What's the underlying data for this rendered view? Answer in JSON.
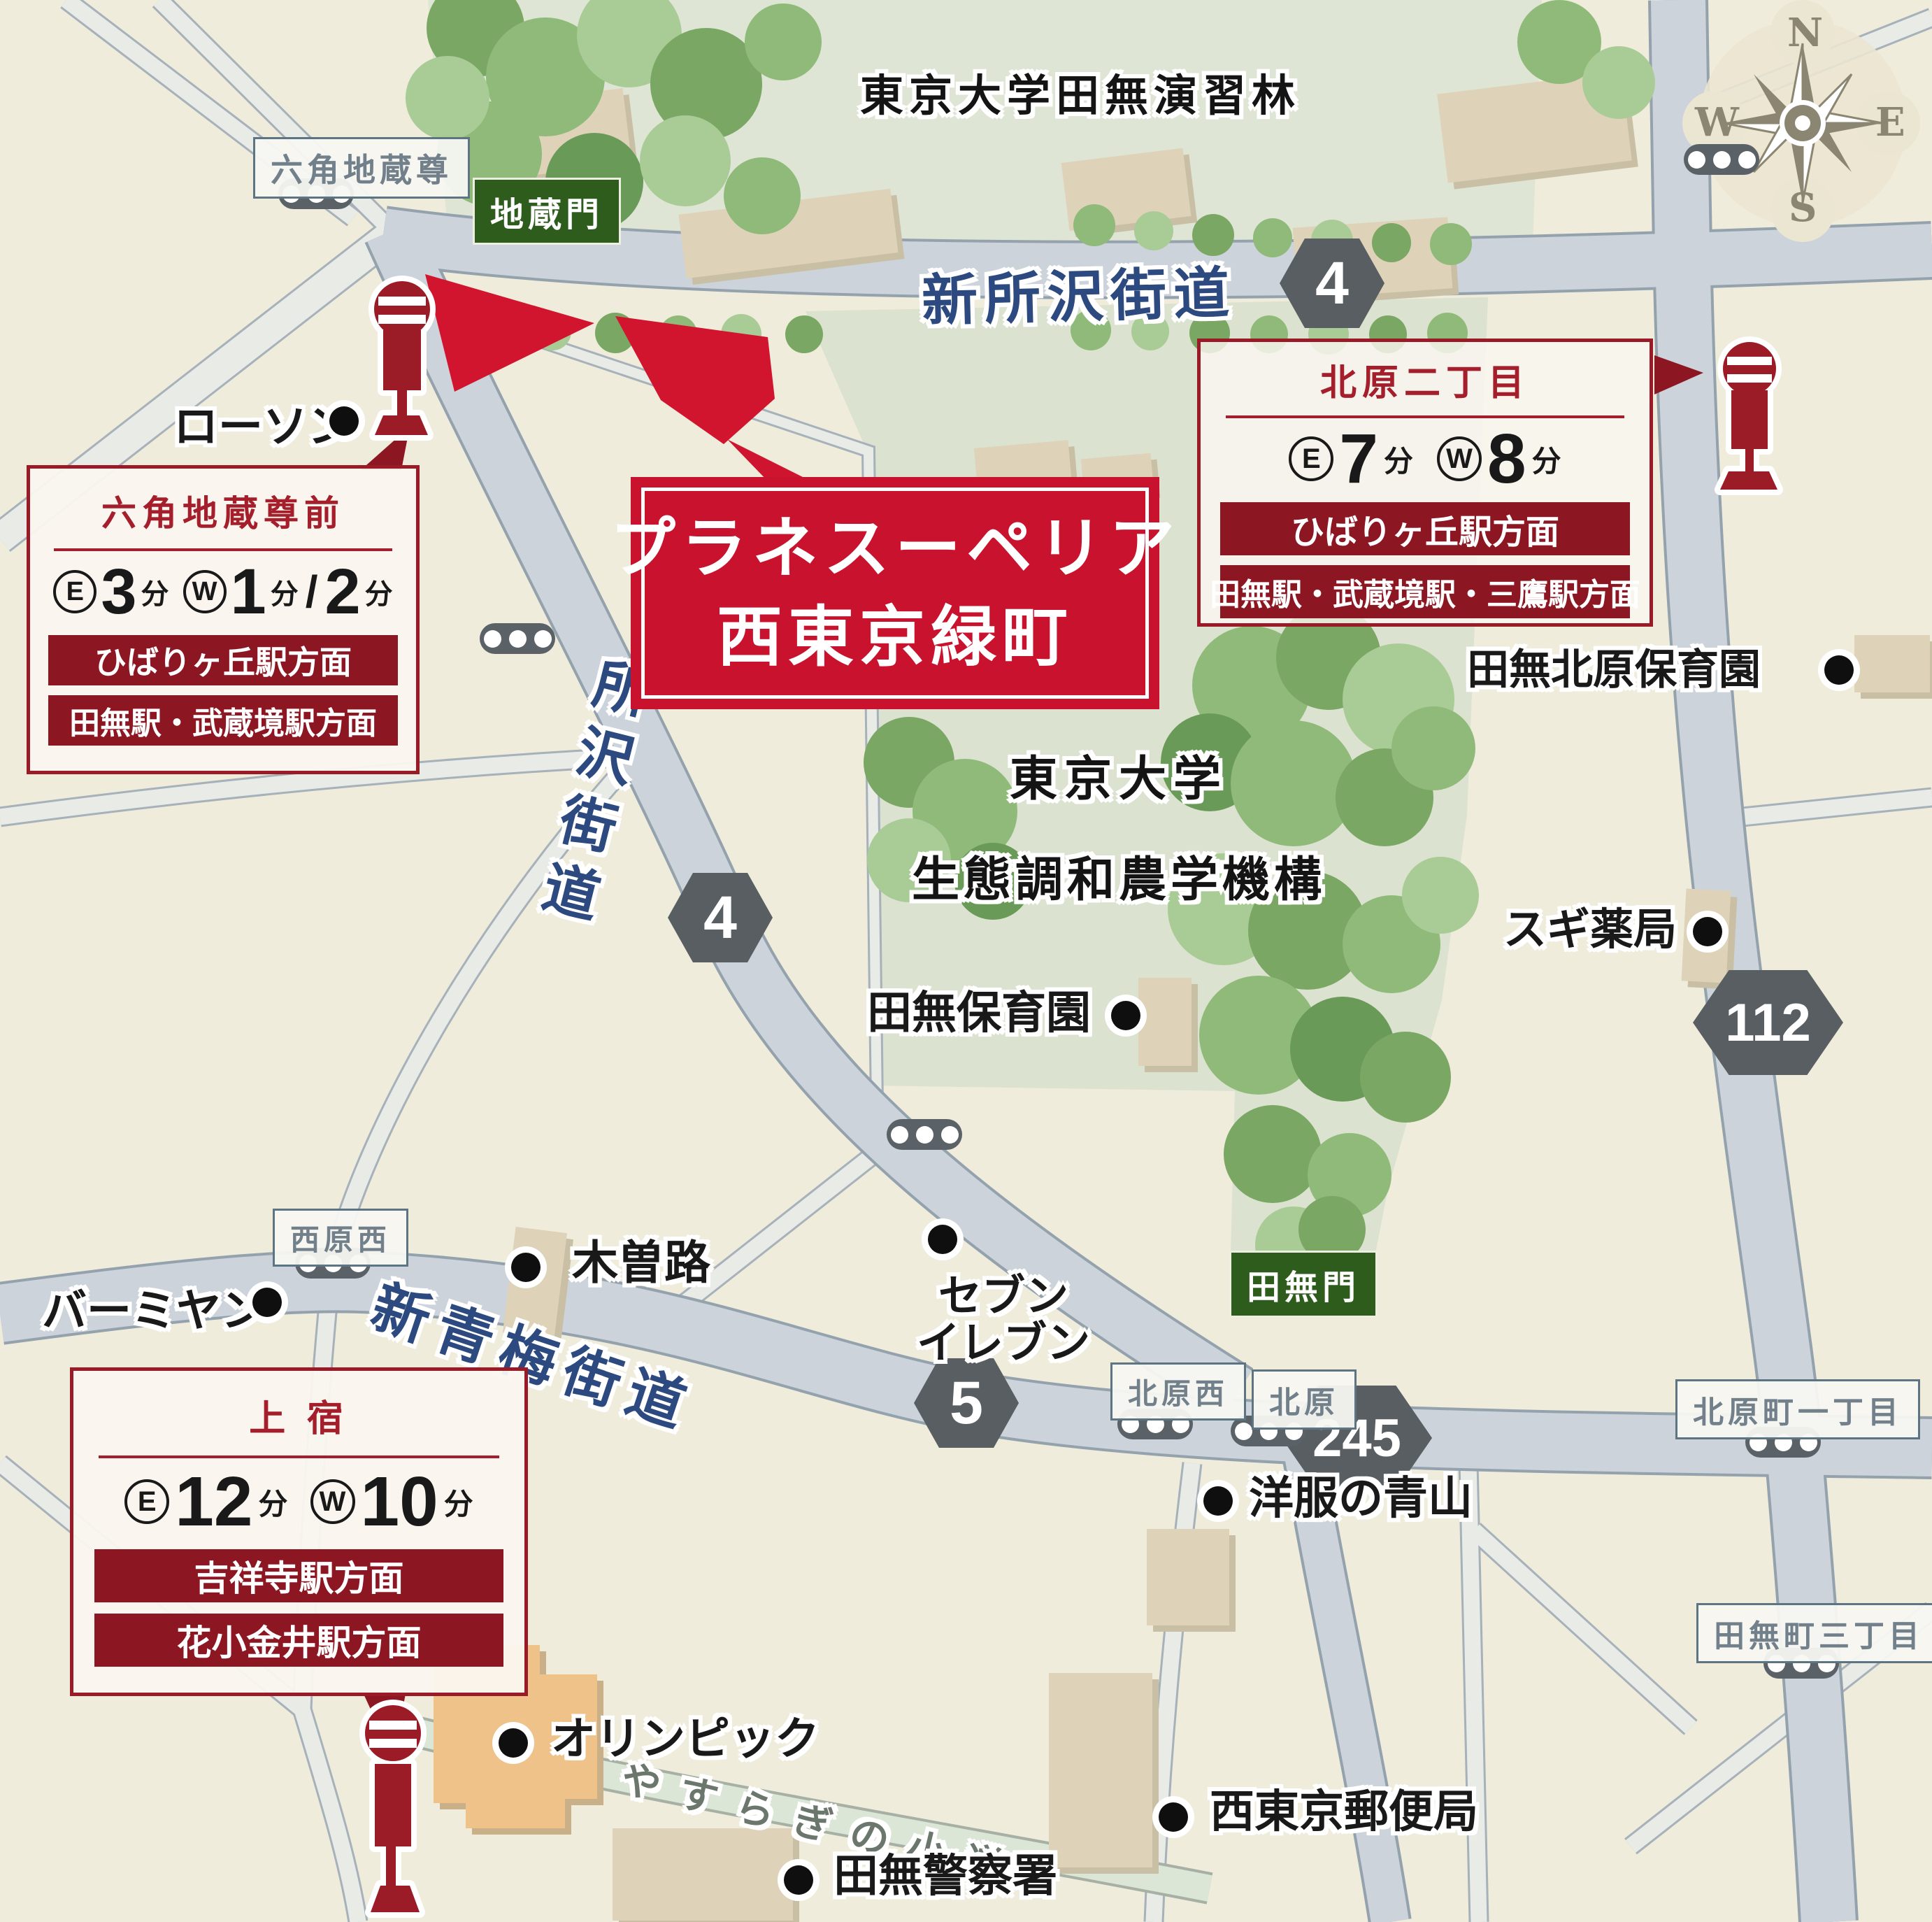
{
  "project": {
    "name_line1": "プラネスーペリア",
    "name_line2": "西東京緑町"
  },
  "labels": {
    "east": "E",
    "west": "W",
    "minute": "分",
    "slash": "/"
  },
  "compass": {
    "n": "N",
    "e": "E",
    "s": "S",
    "w": "W"
  },
  "roads": {
    "shin_tokorozawa": "新所沢街道",
    "tokorozawa": "所沢街道",
    "shin_ome": "新青梅街道",
    "yasuragi_path": "やすらぎの小道"
  },
  "route_badges": {
    "b4a": "4",
    "b4b": "4",
    "b5": "5",
    "b245": "245",
    "b112": "112"
  },
  "areas": {
    "forest": "東京大学田無演習林",
    "univ1": "東京大学",
    "univ2": "生態調和農学機構"
  },
  "gates": {
    "jizo": "地蔵門",
    "tanashi": "田無門"
  },
  "intersections": {
    "rokkaku": "六角地蔵尊",
    "nishiharanishi": "西原西",
    "kitaharanishi": "北原西",
    "kitahara": "北原",
    "kitaharacho": "北原町一丁目",
    "tanashicho": "田無町三丁目"
  },
  "pois": {
    "lawson": "ローソン",
    "kisoji": "木曽路",
    "bamiyan": "バーミヤン",
    "seven1": "セブン",
    "seven2": "イレブン",
    "aoyama": "洋服の青山",
    "olympic": "オリンピック",
    "post": "西東京郵便局",
    "police": "田無警察署",
    "tanashi_hoikuen": "田無保育園",
    "kitahara_hoikuen": "田無北原保育園",
    "sugi": "スギ薬局"
  },
  "bus_stops": {
    "rokkaku": {
      "name": "六角地蔵尊前",
      "east_min": "3",
      "west_min": "1",
      "west_min2": "2",
      "dir1": "ひばりヶ丘駅方面",
      "dir2": "田無駅・武蔵境駅方面"
    },
    "kitahara2": {
      "name": "北原二丁目",
      "east_min": "7",
      "west_min": "8",
      "dir1": "ひばりヶ丘駅方面",
      "dir2": "田無駅・武蔵境駅・三鷹駅方面"
    },
    "kamijuku": {
      "name": "上 宿",
      "east_min": "12",
      "west_min": "10",
      "dir1": "吉祥寺駅方面",
      "dir2": "花小金井駅方面"
    }
  },
  "colors": {
    "accent_red": "#c9122e",
    "parcel_red": "#d2152f",
    "maroon": "#8c1722",
    "road_text_blue": "#2c4a80",
    "badge_gray": "#585e62",
    "gate_green": "#2e5c1c"
  }
}
